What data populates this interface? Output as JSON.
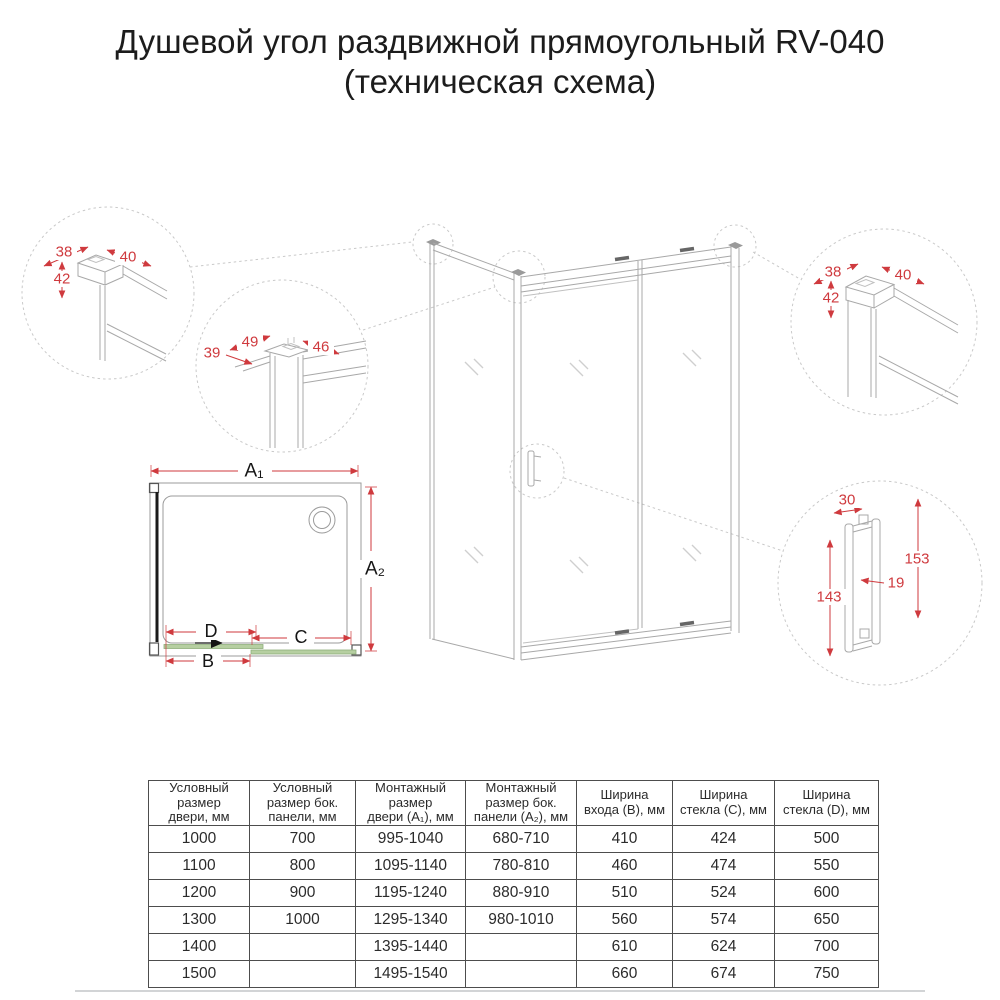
{
  "title": {
    "line1": "Душевой угол раздвижной прямоугольный RV-040",
    "line2": "(техническая схема)"
  },
  "colors": {
    "dimension_red": "#cf3a3e",
    "glass_green": "#b6cfa1",
    "drawing_gray": "#a8a8a8"
  },
  "details": {
    "top_left": {
      "width": "38",
      "depth": "40",
      "height": "42"
    },
    "mid_left": {
      "top": "49",
      "right": "46",
      "left": "39"
    },
    "top_right": {
      "width": "38",
      "depth": "40",
      "height": "42"
    },
    "handle": {
      "width": "30",
      "outer_height": "153",
      "bar_thickness": "19",
      "inner_height": "143"
    }
  },
  "plan": {
    "a1": "A₁",
    "a2": "A₂",
    "b": "B",
    "c": "C",
    "d": "D"
  },
  "table": {
    "headers": [
      "Условный\nразмер\nдвери, мм",
      "Условный\nразмер бок.\nпанели, мм",
      "Монтажный\nразмер\nдвери (A₁), мм",
      "Монтажный\nразмер бок.\nпанели (A₂), мм",
      "Ширина\nвхода (B), мм",
      "Ширина\nстекла (C), мм",
      "Ширина\nстекла (D), мм"
    ],
    "rows": [
      [
        "1000",
        "700",
        "995-1040",
        "680-710",
        "410",
        "424",
        "500"
      ],
      [
        "1100",
        "800",
        "1095-1140",
        "780-810",
        "460",
        "474",
        "550"
      ],
      [
        "1200",
        "900",
        "1195-1240",
        "880-910",
        "510",
        "524",
        "600"
      ],
      [
        "1300",
        "1000",
        "1295-1340",
        "980-1010",
        "560",
        "574",
        "650"
      ],
      [
        "1400",
        "",
        "1395-1440",
        "",
        "610",
        "624",
        "700"
      ],
      [
        "1500",
        "",
        "1495-1540",
        "",
        "660",
        "674",
        "750"
      ]
    ]
  }
}
